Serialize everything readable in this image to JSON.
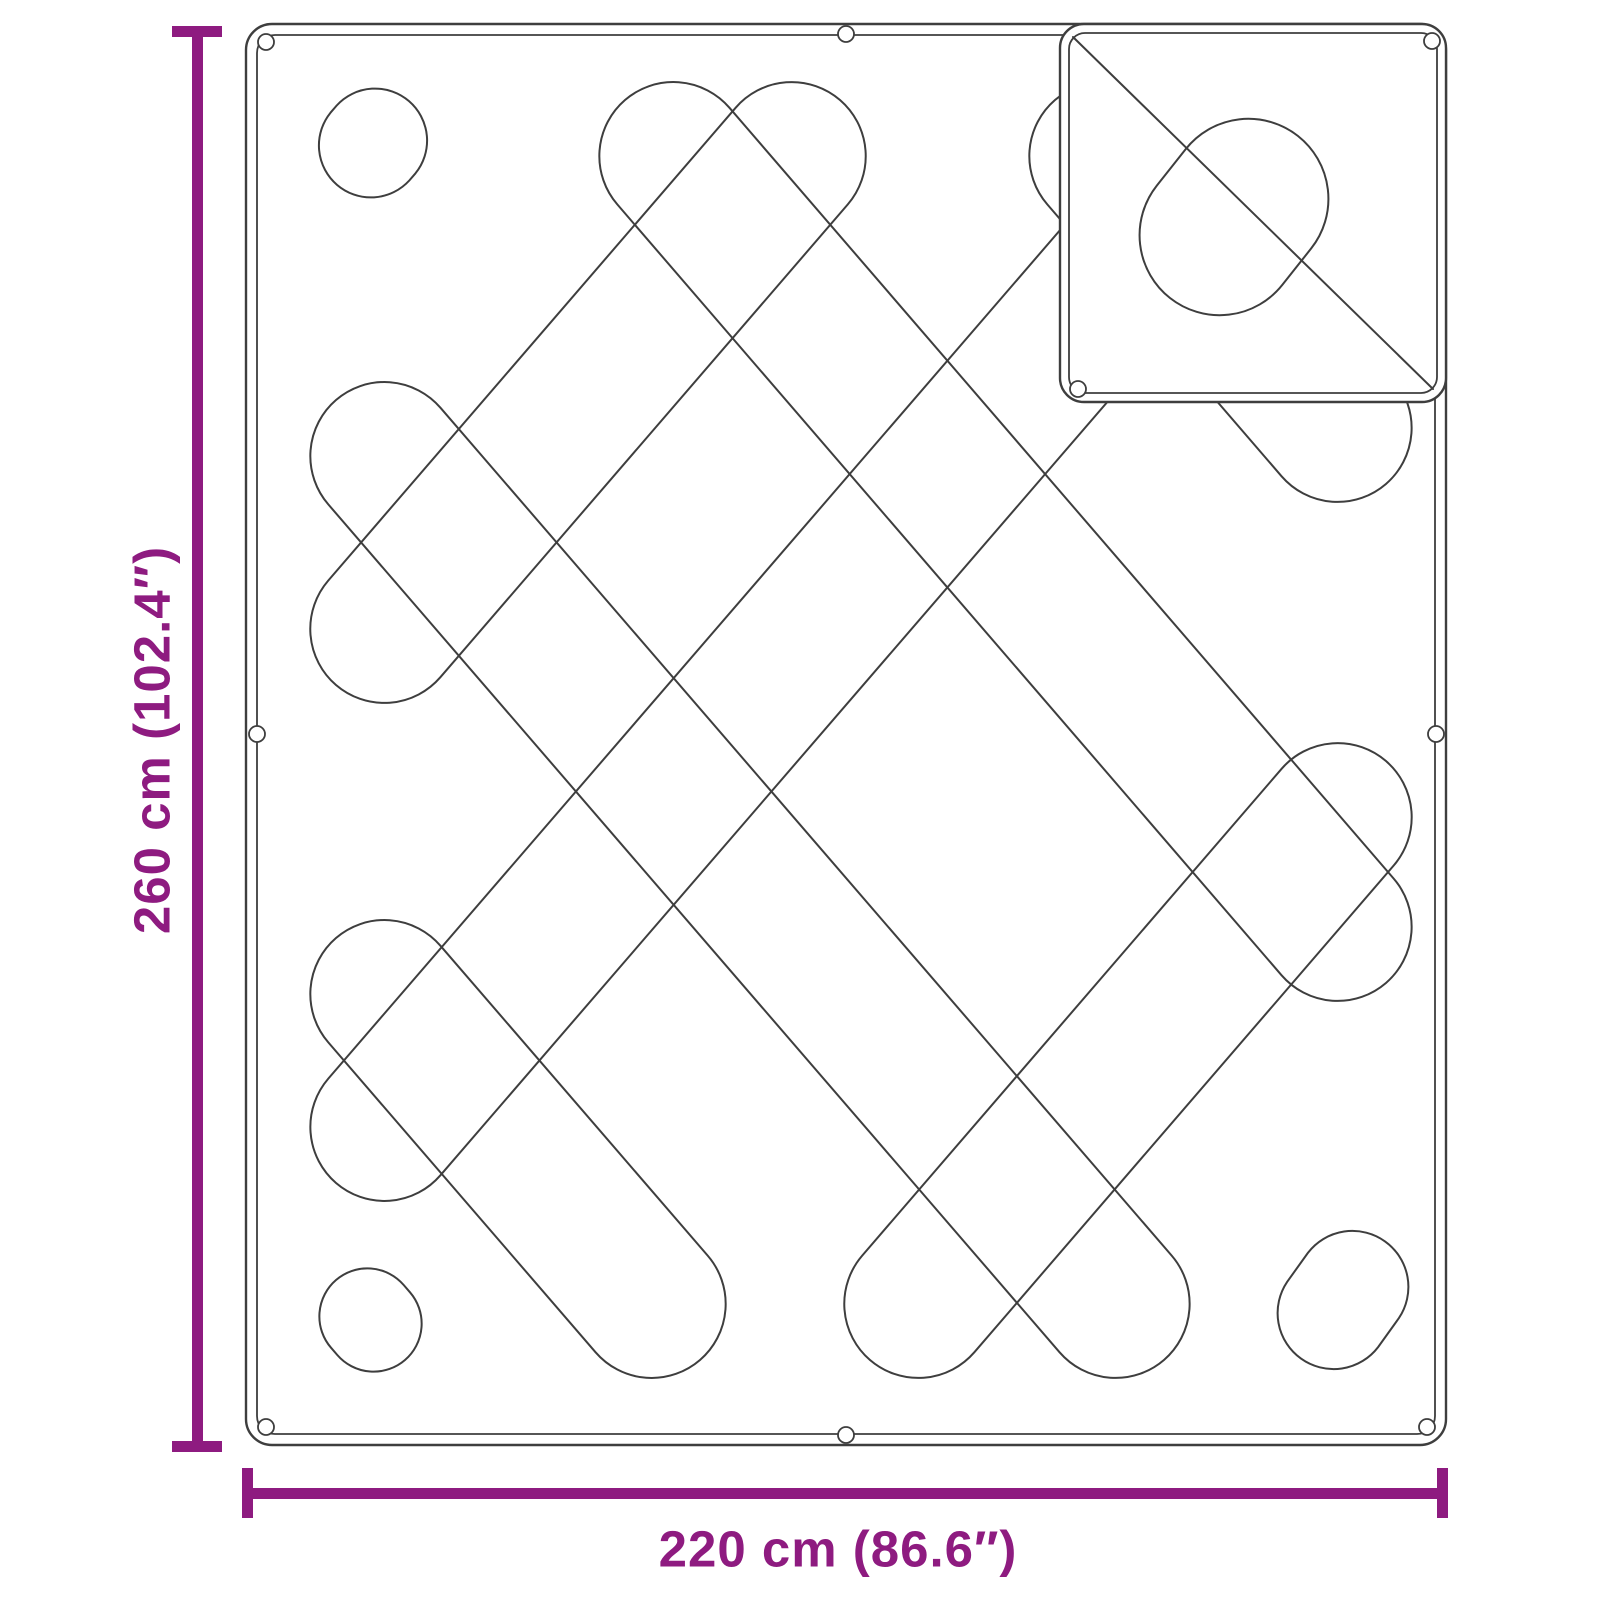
{
  "diagram": {
    "product": "quilted-blanket-with-folded-corner",
    "height_label": "260 cm (102.4″)",
    "width_label": "220 cm (86.6″)",
    "colors": {
      "dimension_accent": "#8E1B80",
      "outline": "#3E3E3E",
      "background": "#FFFFFF"
    }
  }
}
